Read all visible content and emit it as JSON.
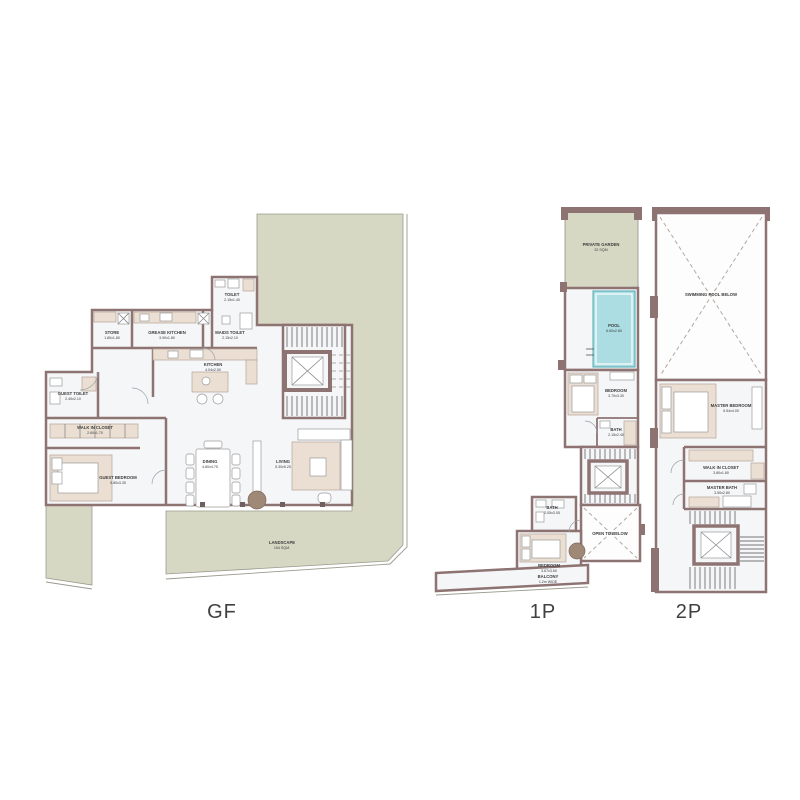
{
  "colors": {
    "wall": "#8e7373",
    "landscape": "#d6d8c3",
    "pool": "#abdde2",
    "floor": "#f5f6f8",
    "furniture": "#eadfd2",
    "planter": "#a08876",
    "label": "#3c3c3c"
  },
  "plans": {
    "gf": {
      "title": "GF",
      "rooms": [
        {
          "name": "TOILET",
          "dim": "2.15x1.40"
        },
        {
          "name": "STORE",
          "dim": "1.80x1.80"
        },
        {
          "name": "GREASE KITCHEN",
          "dim": "3.90x1.80"
        },
        {
          "name": "MAIDS TOILET",
          "dim": "2.15x2.10"
        },
        {
          "name": "KITCHEN",
          "dim": "4.04x2.50"
        },
        {
          "name": "GUEST TOILET",
          "dim": "2.40x2.10"
        },
        {
          "name": "WALK IN CLOSET",
          "dim": "2.60x1.70"
        },
        {
          "name": "GUEST BEDROOM",
          "dim": "5.80x3.35"
        },
        {
          "name": "DINING",
          "dim": "4.80x4.75"
        },
        {
          "name": "LIVING",
          "dim": "5.30x5.25"
        },
        {
          "name": "LANDSCAPE",
          "dim": "154 SQM."
        }
      ]
    },
    "p1": {
      "title": "1P",
      "rooms": [
        {
          "name": "PRIVATE GARDEN",
          "dim": "32 SQM"
        },
        {
          "name": "POOL",
          "dim": "6.60x2.80"
        },
        {
          "name": "BEDROOM",
          "dim": "3.70x3.30"
        },
        {
          "name": "BATH",
          "dim": "2.15x2.40"
        },
        {
          "name": "OPEN TO BELOW",
          "dim": ""
        },
        {
          "name": "BATH",
          "dim": "2.05x3.05"
        },
        {
          "name": "BEDROOM",
          "dim": "3.67x3.60"
        },
        {
          "name": "BALCONY",
          "dim": "1.2m WIDE"
        }
      ]
    },
    "p2": {
      "title": "2P",
      "rooms": [
        {
          "name": "SWIMMING POOL BELOW",
          "dim": ""
        },
        {
          "name": "MASTER BEDROOM",
          "dim": "5.54x4.00"
        },
        {
          "name": "WALK IN CLOSET",
          "dim": "3.80x1.80"
        },
        {
          "name": "MASTER BATH",
          "dim": "3.50x2.80"
        }
      ]
    }
  }
}
